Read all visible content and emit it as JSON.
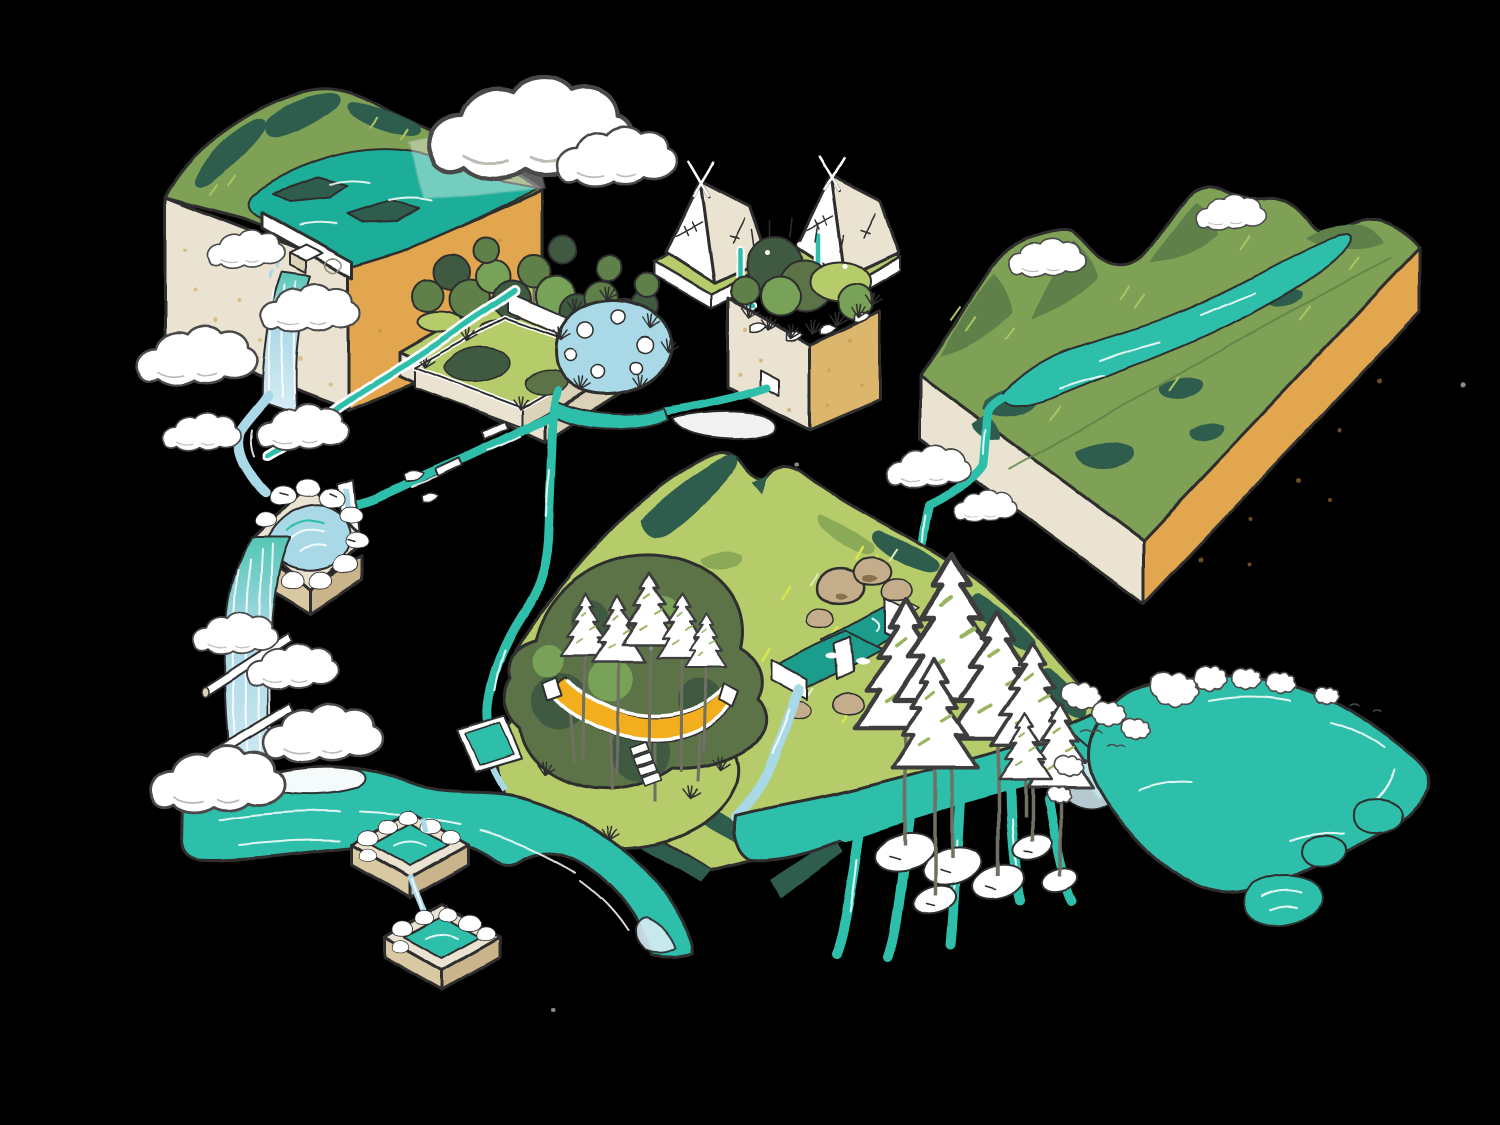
{
  "image": {
    "width": 1125,
    "height": 1125,
    "description": "Hand-drawn isometric watershed illustration: water flows from a dammed reservoir block, rain-collector tents over a soil cube, and a mountain-valley block, through wetlands, weirs, check dams, waterfalls and braided tree deltas into a lake",
    "background_note": "illustration floats on a plain black background, no text labels anywhere"
  },
  "palette": {
    "background": "#000000",
    "ink": "#2e2e2e",
    "water_teal": "#2fbfab",
    "water_teal_deep": "#1a9c8b",
    "reservoir_teal": "#1fae99",
    "water_light": "#a9d8e6",
    "water_pale": "#d8edf5",
    "grass_light": "#b6cc6b",
    "grass_mid": "#7fa155",
    "grass_olive": "#5e8049",
    "green_dark": "#2e5b4e",
    "forest_olive": "#5c7247",
    "forest_dark": "#3f5a42",
    "forest_light": "#77a258",
    "soil_cream": "#eae3d1",
    "soil_cream_shade": "#dcd2b8",
    "soil_orange": "#e2a64f",
    "soil_sand": "#dcb66c",
    "block_tan": "#d8c9a2",
    "block_tan_dark": "#c9b48c",
    "rock_tan": "#c4ad8b",
    "walkway_orange": "#f2ae1e",
    "cloud_white": "#ffffff",
    "cloud_line": "#4a4a4a",
    "hatch_yellow": "#d9e54d",
    "hatch_light": "#a9c463",
    "trunk_grey": "#6f6f64"
  },
  "scene": {
    "components": [
      {
        "id": "reservoir-block",
        "label": "Reservoir block with dam, spillway and waterfall"
      },
      {
        "id": "garden-terrace",
        "label": "Forest garden terrace with raised bed and aqueduct"
      },
      {
        "id": "rain-tents",
        "label": "Two rain-collector tents on green platforms"
      },
      {
        "id": "soil-cube",
        "label": "Soil cube with dense vegetation and outlet hole"
      },
      {
        "id": "wetland-pond",
        "label": "Wetland pond with grasses, rocks and stream junction"
      },
      {
        "id": "valley-block",
        "label": "Mountain valley block with long lake"
      },
      {
        "id": "central-mountain",
        "label": "Central mountain"
      },
      {
        "id": "forest-knoll",
        "label": "Forest knoll with white conifers and orange canopy walkway"
      },
      {
        "id": "check-dams",
        "label": "Two check-dam basins with boulders"
      },
      {
        "id": "cascade-pool",
        "label": "Rock-rimmed plunge pool on tan block"
      },
      {
        "id": "waterfall-cascade",
        "label": "Tall waterfall crossed by two pipes"
      },
      {
        "id": "main-river",
        "label": "Wide river below the cascade"
      },
      {
        "id": "infiltration-pools",
        "label": "Two small stacked infiltration pool blocks"
      },
      {
        "id": "delta-trees",
        "label": "Braided delta with white conifers on stone mounds"
      },
      {
        "id": "lake",
        "label": "Large teal lake with satellite ponds and white scrub"
      },
      {
        "id": "clouds",
        "label": "Sketchy white clouds and rain veil"
      }
    ],
    "counts": {
      "tents": 2,
      "check_dam_basins": 2,
      "infiltration_pools": 2,
      "waterfall_pipes": 2,
      "knoll_conifers": 5,
      "delta_conifers": 7,
      "clouds": 15
    }
  }
}
